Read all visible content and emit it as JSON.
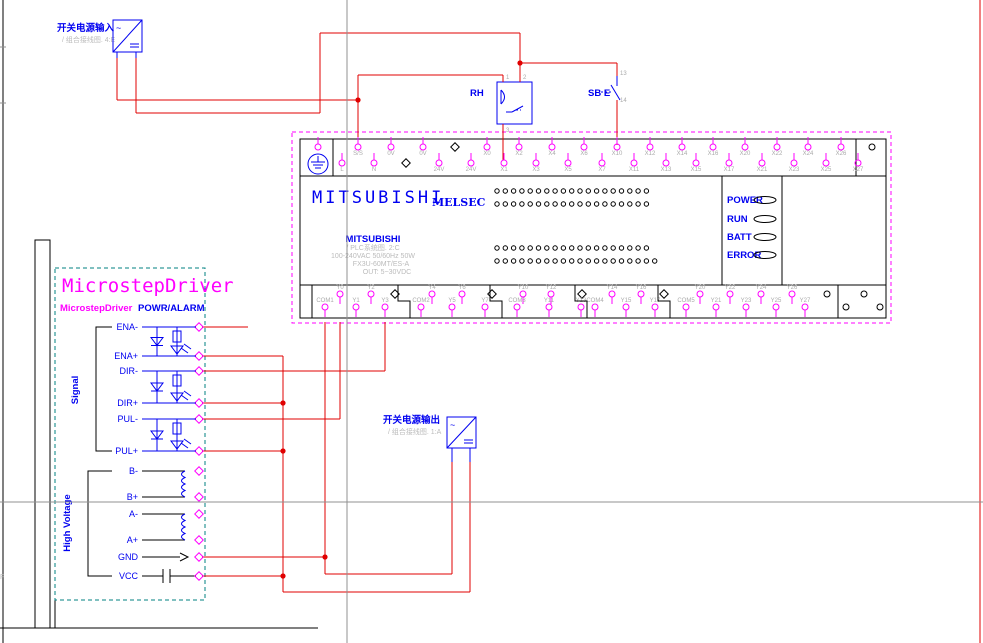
{
  "colors": {
    "wire": "#e00000",
    "symbol_blue": "#0000f0",
    "terminal_magenta": "#ff00ff",
    "driver_border": "#008080",
    "crosshair": "#909090",
    "faint_gray": "#bbbbbb"
  },
  "frame": {
    "zone_letter": "F"
  },
  "power_input": {
    "label": "开关电源输入",
    "ref": "/ 组合接线图. 4:E"
  },
  "power_output": {
    "label": "开关电源输出",
    "ref": "/ 组合接线图. 1:A"
  },
  "relay": {
    "label": "RH",
    "pins": [
      "1",
      "2",
      "3"
    ]
  },
  "switch": {
    "label": "SB E",
    "pins": [
      "13",
      "14"
    ]
  },
  "plc": {
    "brand": "MITSUBISHI",
    "series": "MELSEC",
    "model": {
      "name": "MITSUBISHI",
      "ref": "/ PLC系统图. 2:C",
      "power": "100-240VAC 50/60Hz 50W",
      "type": "FX3U-60MT/ES-A",
      "out": "OUT: 5~30VDC"
    },
    "leds": [
      {
        "label": "POWER",
        "y": 200
      },
      {
        "label": "RUN",
        "y": 219
      },
      {
        "label": "BATT",
        "y": 237
      },
      {
        "label": "ERROR",
        "y": 255
      }
    ],
    "top_row_a": {
      "cy": 147,
      "label_y": 155,
      "pins": [
        {
          "x": 318,
          "l": ""
        },
        {
          "x": 358,
          "l": "S/S"
        },
        {
          "x": 391,
          "l": "0V"
        },
        {
          "x": 423,
          "l": "0V"
        },
        {
          "x": 455,
          "t": "nc"
        },
        {
          "x": 487,
          "l": "X0"
        },
        {
          "x": 519,
          "l": "X2"
        },
        {
          "x": 552,
          "l": "X4"
        },
        {
          "x": 584,
          "l": "X6"
        },
        {
          "x": 617,
          "l": "X10"
        },
        {
          "x": 650,
          "l": "X12"
        },
        {
          "x": 682,
          "l": "X14"
        },
        {
          "x": 713,
          "l": "X16"
        },
        {
          "x": 745,
          "l": "X20"
        },
        {
          "x": 777,
          "l": "X22"
        },
        {
          "x": 808,
          "l": "X24"
        },
        {
          "x": 841,
          "l": "X26"
        },
        {
          "x": 872,
          "t": "circ"
        }
      ]
    },
    "top_row_b": {
      "cy": 163,
      "label_y": 171,
      "pins": [
        {
          "x": 342,
          "l": "L"
        },
        {
          "x": 374,
          "l": "N"
        },
        {
          "x": 406,
          "t": "nc"
        },
        {
          "x": 439,
          "l": "24V"
        },
        {
          "x": 471,
          "l": "24V"
        },
        {
          "x": 504,
          "l": "X1"
        },
        {
          "x": 536,
          "l": "X3"
        },
        {
          "x": 568,
          "l": "X5"
        },
        {
          "x": 602,
          "l": "X7"
        },
        {
          "x": 634,
          "l": "X11"
        },
        {
          "x": 666,
          "l": "X13"
        },
        {
          "x": 696,
          "l": "X15"
        },
        {
          "x": 729,
          "l": "X17"
        },
        {
          "x": 762,
          "l": "X21"
        },
        {
          "x": 794,
          "l": "X23"
        },
        {
          "x": 826,
          "l": "X25"
        },
        {
          "x": 858,
          "l": "X27"
        }
      ]
    },
    "bottom_row_a": {
      "cy": 294,
      "label_y": 289,
      "pins": [
        {
          "x": 340,
          "l": "Y0"
        },
        {
          "x": 371,
          "l": "Y2"
        },
        {
          "x": 395,
          "t": "nc"
        },
        {
          "x": 432,
          "l": "Y4"
        },
        {
          "x": 462,
          "l": "Y6"
        },
        {
          "x": 492,
          "t": "nc"
        },
        {
          "x": 523,
          "l": "Y10"
        },
        {
          "x": 551,
          "l": "Y12"
        },
        {
          "x": 582,
          "t": "nc"
        },
        {
          "x": 612,
          "l": "Y14"
        },
        {
          "x": 641,
          "l": "Y16"
        },
        {
          "x": 664,
          "t": "nc"
        },
        {
          "x": 700,
          "l": "Y20"
        },
        {
          "x": 730,
          "l": "Y22"
        },
        {
          "x": 761,
          "l": "Y24"
        },
        {
          "x": 792,
          "l": "Y26"
        },
        {
          "x": 827,
          "t": "circ"
        },
        {
          "x": 864,
          "t": "circ"
        }
      ]
    },
    "bottom_row_b": {
      "cy": 307,
      "label_y": 302,
      "pins": [
        {
          "x": 325,
          "l": "COM1"
        },
        {
          "x": 356,
          "l": "Y1"
        },
        {
          "x": 385,
          "l": "Y3"
        },
        {
          "x": 421,
          "l": "COM2"
        },
        {
          "x": 452,
          "l": "Y5"
        },
        {
          "x": 485,
          "l": "Y7"
        },
        {
          "x": 517,
          "l": "COM3"
        },
        {
          "x": 549,
          "l": "Y11"
        },
        {
          "x": 581,
          "l": "Y13"
        },
        {
          "x": 595,
          "l": "COM4"
        },
        {
          "x": 626,
          "l": "Y15"
        },
        {
          "x": 655,
          "l": "Y17"
        },
        {
          "x": 686,
          "l": "COM5"
        },
        {
          "x": 716,
          "l": "Y21"
        },
        {
          "x": 746,
          "l": "Y23"
        },
        {
          "x": 776,
          "l": "Y25"
        },
        {
          "x": 805,
          "l": "Y27"
        },
        {
          "x": 846,
          "t": "circ"
        },
        {
          "x": 880,
          "t": "circ"
        }
      ]
    },
    "step_dividers": [
      [
        398,
        410
      ],
      [
        490,
        502
      ],
      [
        575,
        587
      ],
      [
        658,
        670
      ]
    ],
    "matrix": {
      "x0": 497,
      "dx": 8.3,
      "r": 2.2,
      "rows": [
        {
          "y": 191,
          "n": 19
        },
        {
          "y": 204,
          "n": 19
        },
        {
          "y": 248,
          "n": 19
        },
        {
          "y": 261,
          "n": 20
        }
      ]
    }
  },
  "driver": {
    "title": "MicrostepDriver",
    "subtitle": "MicrostepDriver",
    "power_alarm": "POWR/ALARM",
    "group_signal": "Signal",
    "group_hv": "High Voltage",
    "terminals": [
      {
        "y": 327,
        "l": "ENA-"
      },
      {
        "y": 356,
        "l": "ENA+"
      },
      {
        "y": 371,
        "l": "DIR-"
      },
      {
        "y": 403,
        "l": "DIR+"
      },
      {
        "y": 419,
        "l": "PUL-"
      },
      {
        "y": 451,
        "l": "PUL+"
      },
      {
        "y": 471,
        "l": "B-"
      },
      {
        "y": 497,
        "l": "B+"
      },
      {
        "y": 514,
        "l": "A-"
      },
      {
        "y": 540,
        "l": "A+"
      },
      {
        "y": 557,
        "l": "GND"
      },
      {
        "y": 576,
        "l": "VCC"
      }
    ],
    "opto_stages": [
      {
        "t": 327,
        "b": 356
      },
      {
        "t": 371,
        "b": 403
      },
      {
        "t": 419,
        "b": 451
      }
    ],
    "coil_stages": [
      {
        "t": 471,
        "b": 497
      },
      {
        "t": 514,
        "b": 540
      }
    ]
  },
  "wires": [
    [
      117,
      58,
      117,
      100
    ],
    [
      117,
      100,
      358,
      100
    ],
    [
      136,
      58,
      136,
      113
    ],
    [
      136,
      113,
      320,
      113
    ],
    [
      320,
      33,
      320,
      113
    ],
    [
      320,
      33,
      520,
      33
    ],
    [
      520,
      33,
      520,
      82
    ],
    [
      520,
      63,
      617,
      63
    ],
    [
      617,
      63,
      617,
      76
    ],
    [
      617,
      100,
      617,
      145
    ],
    [
      358,
      75,
      503,
      75
    ],
    [
      503,
      75,
      503,
      82
    ],
    [
      358,
      75,
      358,
      144
    ],
    [
      503,
      124,
      503,
      160
    ],
    [
      325,
      322,
      325,
      574
    ],
    [
      202,
      557,
      325,
      557
    ],
    [
      325,
      574,
      452,
      574
    ],
    [
      452,
      462,
      452,
      574
    ],
    [
      340,
      322,
      340,
      419
    ],
    [
      202,
      419,
      340,
      419
    ],
    [
      385,
      322,
      385,
      371
    ],
    [
      202,
      371,
      385,
      371
    ],
    [
      202,
      356,
      283,
      356
    ],
    [
      283,
      356,
      283,
      592
    ],
    [
      202,
      403,
      283,
      403
    ],
    [
      202,
      451,
      283,
      451
    ],
    [
      202,
      576,
      283,
      576
    ],
    [
      283,
      592,
      470,
      592
    ],
    [
      470,
      462,
      470,
      592
    ],
    [
      202,
      327,
      248,
      327
    ],
    [
      980,
      0,
      980,
      643
    ]
  ],
  "junctions": [
    [
      358,
      100
    ],
    [
      520,
      63
    ],
    [
      283,
      403
    ],
    [
      283,
      451
    ],
    [
      283,
      576
    ],
    [
      325,
      557
    ]
  ]
}
